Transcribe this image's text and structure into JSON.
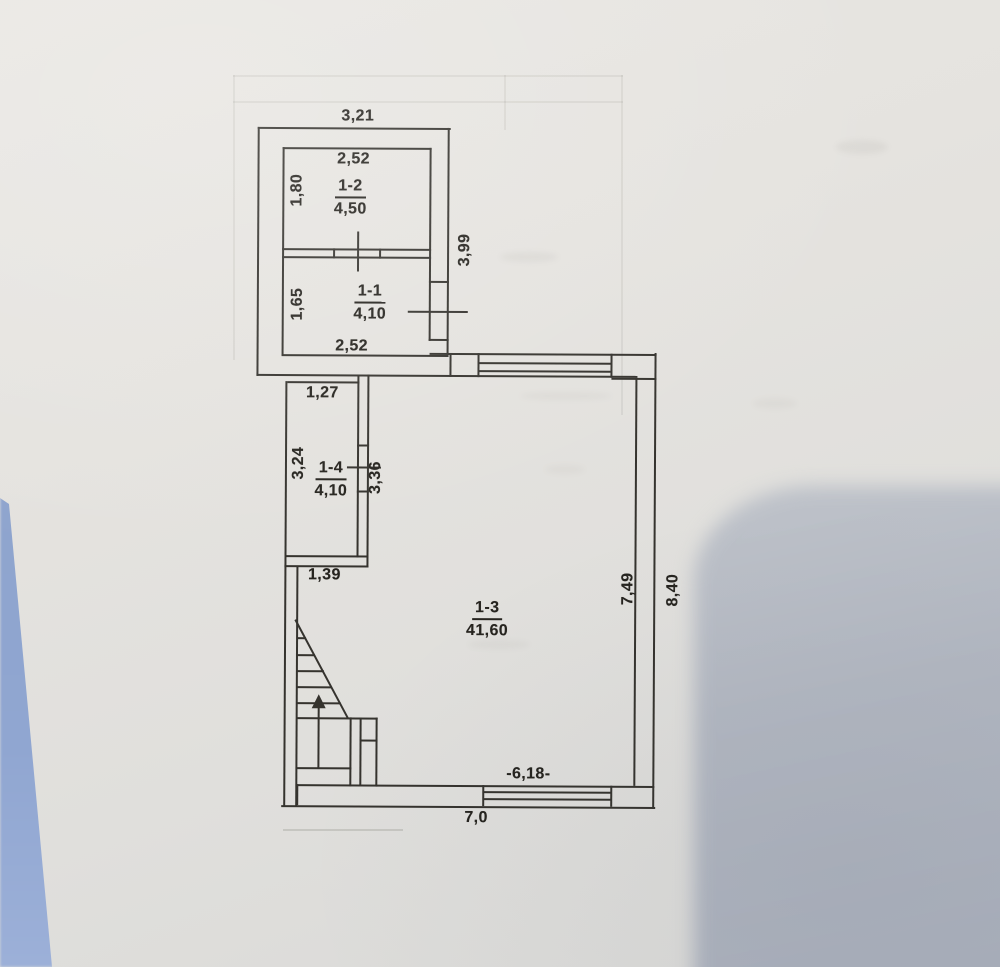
{
  "document": {
    "type": "floor-plan photograph",
    "colors": {
      "paper": "#e4e2de",
      "ink": "#35332e",
      "photo_edge_blue": "#90a6d1",
      "corner_shadow": "#aeb4bf"
    }
  },
  "rooms": {
    "r12": {
      "id": "1-2",
      "area": "4,50"
    },
    "r11": {
      "id": "1-1",
      "area": "4,10"
    },
    "r14": {
      "id": "1-4",
      "area": "4,10"
    },
    "r13": {
      "id": "1-3",
      "area": "41,60"
    }
  },
  "dims": {
    "top_width": "3,21",
    "r12_width": "2,52",
    "r12_depth": "1,80",
    "top_block_height": "3,99",
    "r11_depth": "1,65",
    "r11_width": "2,52",
    "r14_top_width": "1,27",
    "r14_height": "3,24",
    "r14_inner_height": "3,36",
    "r14_bottom_width": "1,39",
    "main_inner_height": "7,49",
    "main_outer_height": "8,40",
    "main_inner_width": "-6,18-",
    "main_outer_width": "7,0"
  }
}
